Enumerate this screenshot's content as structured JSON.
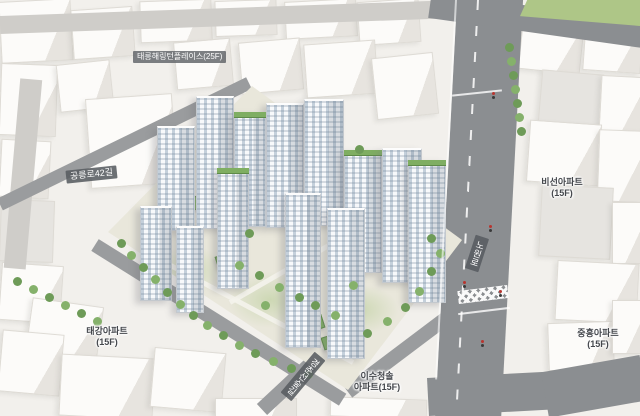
{
  "view": {
    "type": "3d-aerial-map-render",
    "subject": "apartment-complex-massing-model"
  },
  "labels": {
    "complex": "태릉해링턴플레이스(25F)",
    "roads": {
      "west": "공릉로42길",
      "east": "노원로",
      "south": "경춘선숲길"
    },
    "apartments": {
      "taegang": {
        "name": "태강아파트",
        "floors": "(15F)"
      },
      "biseon": {
        "name": "비선아파트",
        "floors": "(15F)"
      },
      "isucheongsol": {
        "name": "이수청솔",
        "floors": "아파트(15F)"
      },
      "jungheung": {
        "name": "중흥아파트",
        "floors": "(15F)"
      }
    }
  },
  "colors": {
    "road": "#8b8e91",
    "grass": "#aec687",
    "tree": "#6e9b58",
    "site_ground": "#e9e7db",
    "building_face": "#f7f9fb",
    "window_tint": "#7d96af",
    "label_chip": "#585c61",
    "label_text": "#ffffff",
    "apartment_label_text": "#44474c",
    "green_roof": "#7fae62"
  }
}
